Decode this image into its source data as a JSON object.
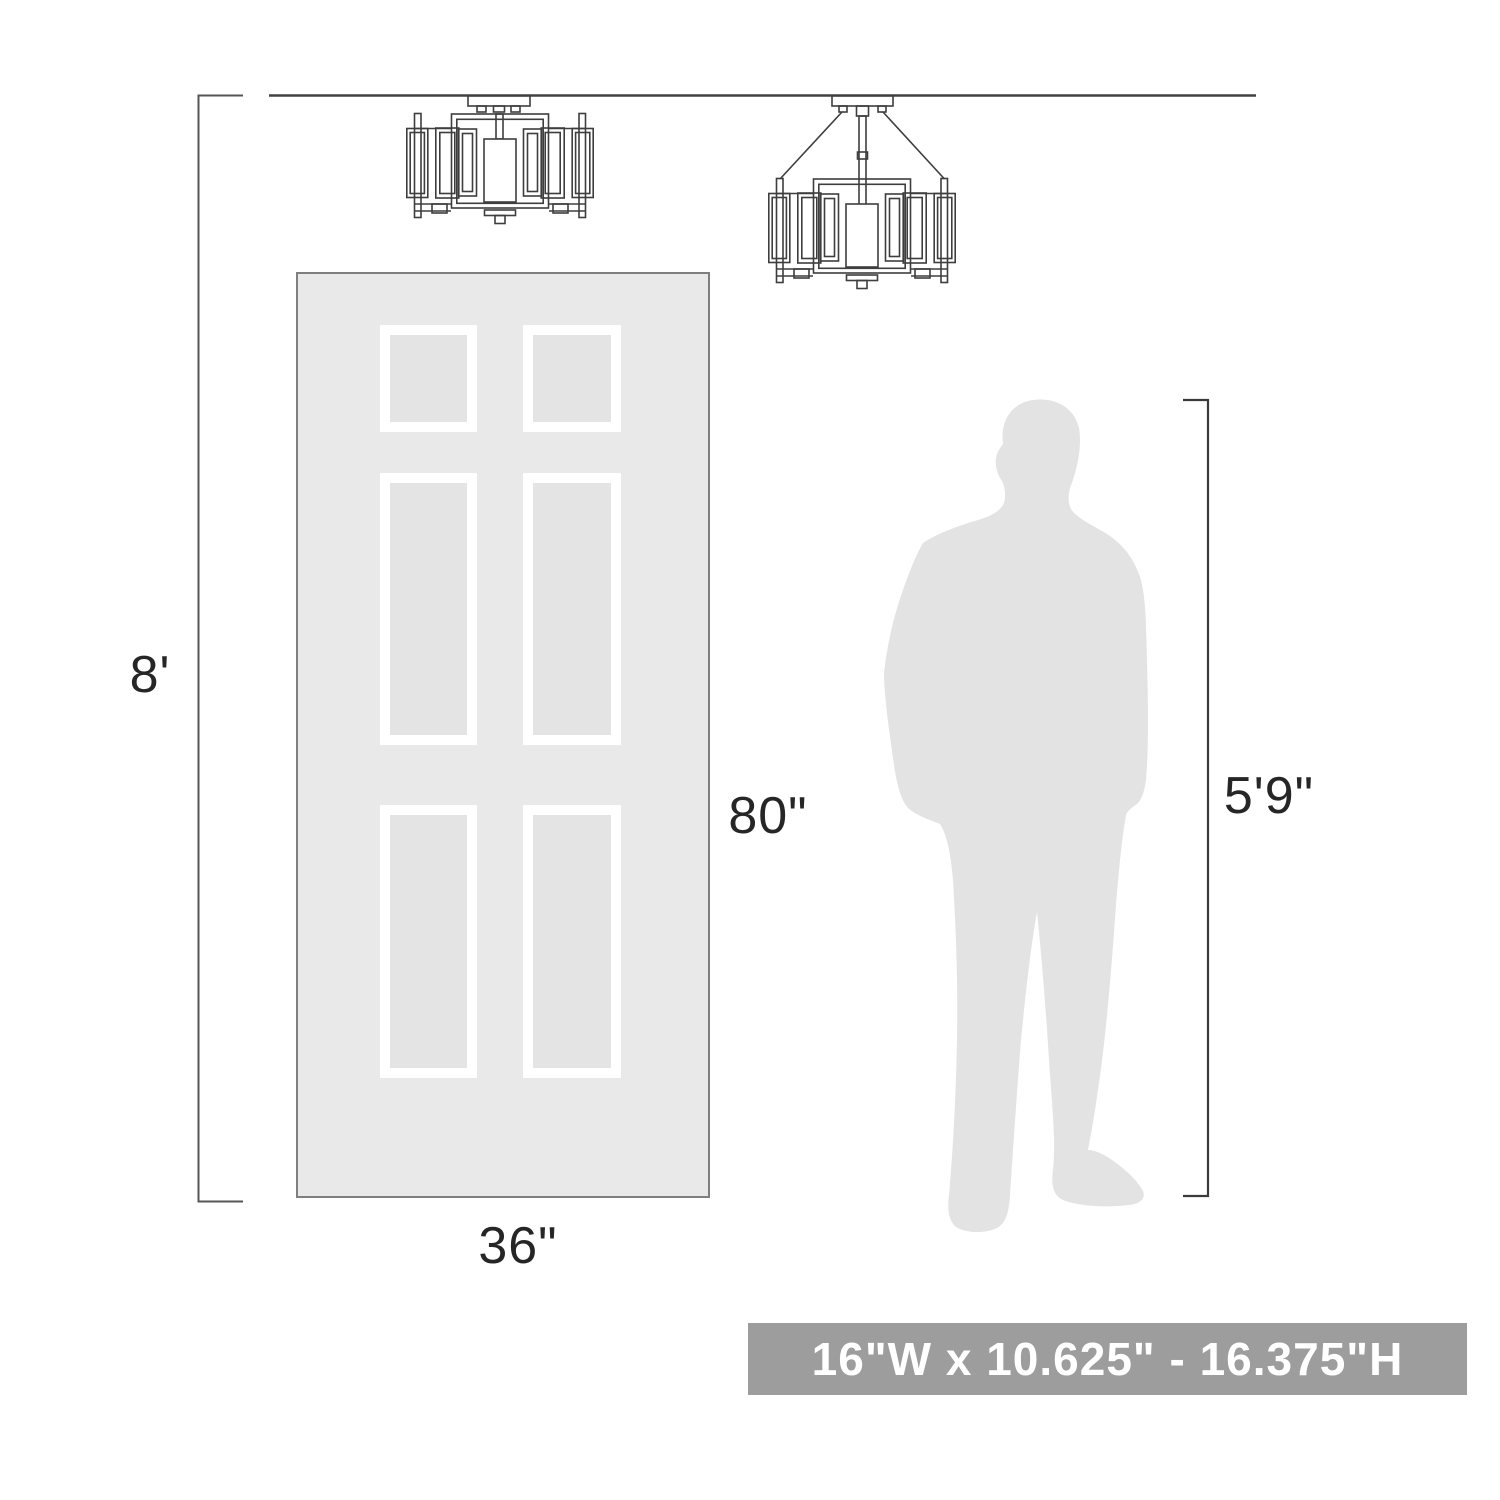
{
  "title": "Lighting fixture scale dimensions diagram",
  "labels": {
    "ceiling_height": "8'",
    "door_height": "80\"",
    "door_width": "36\"",
    "person_height": "5'9\""
  },
  "banner": {
    "text": "16\"W x 10.625\" - 16.375\"H",
    "bg": "#9d9d9d",
    "fg": "#ffffff"
  },
  "colors": {
    "line": "#4b4b4b",
    "fixline": "#3e3e3e",
    "door_fill": "#e9e9e9",
    "door_panel": "#e4e4e4",
    "panel_frame": "#ffffff",
    "silhouette": "#e3e3e3",
    "text": "#262626"
  },
  "icons": {
    "flush_fixture": "semi-flush-cage-light-line-drawing",
    "rod_fixture": "semi-flush-cage-light-with-downrod-line-drawing",
    "door": "six-panel-door-illustration",
    "person": "standing-man-silhouette"
  }
}
